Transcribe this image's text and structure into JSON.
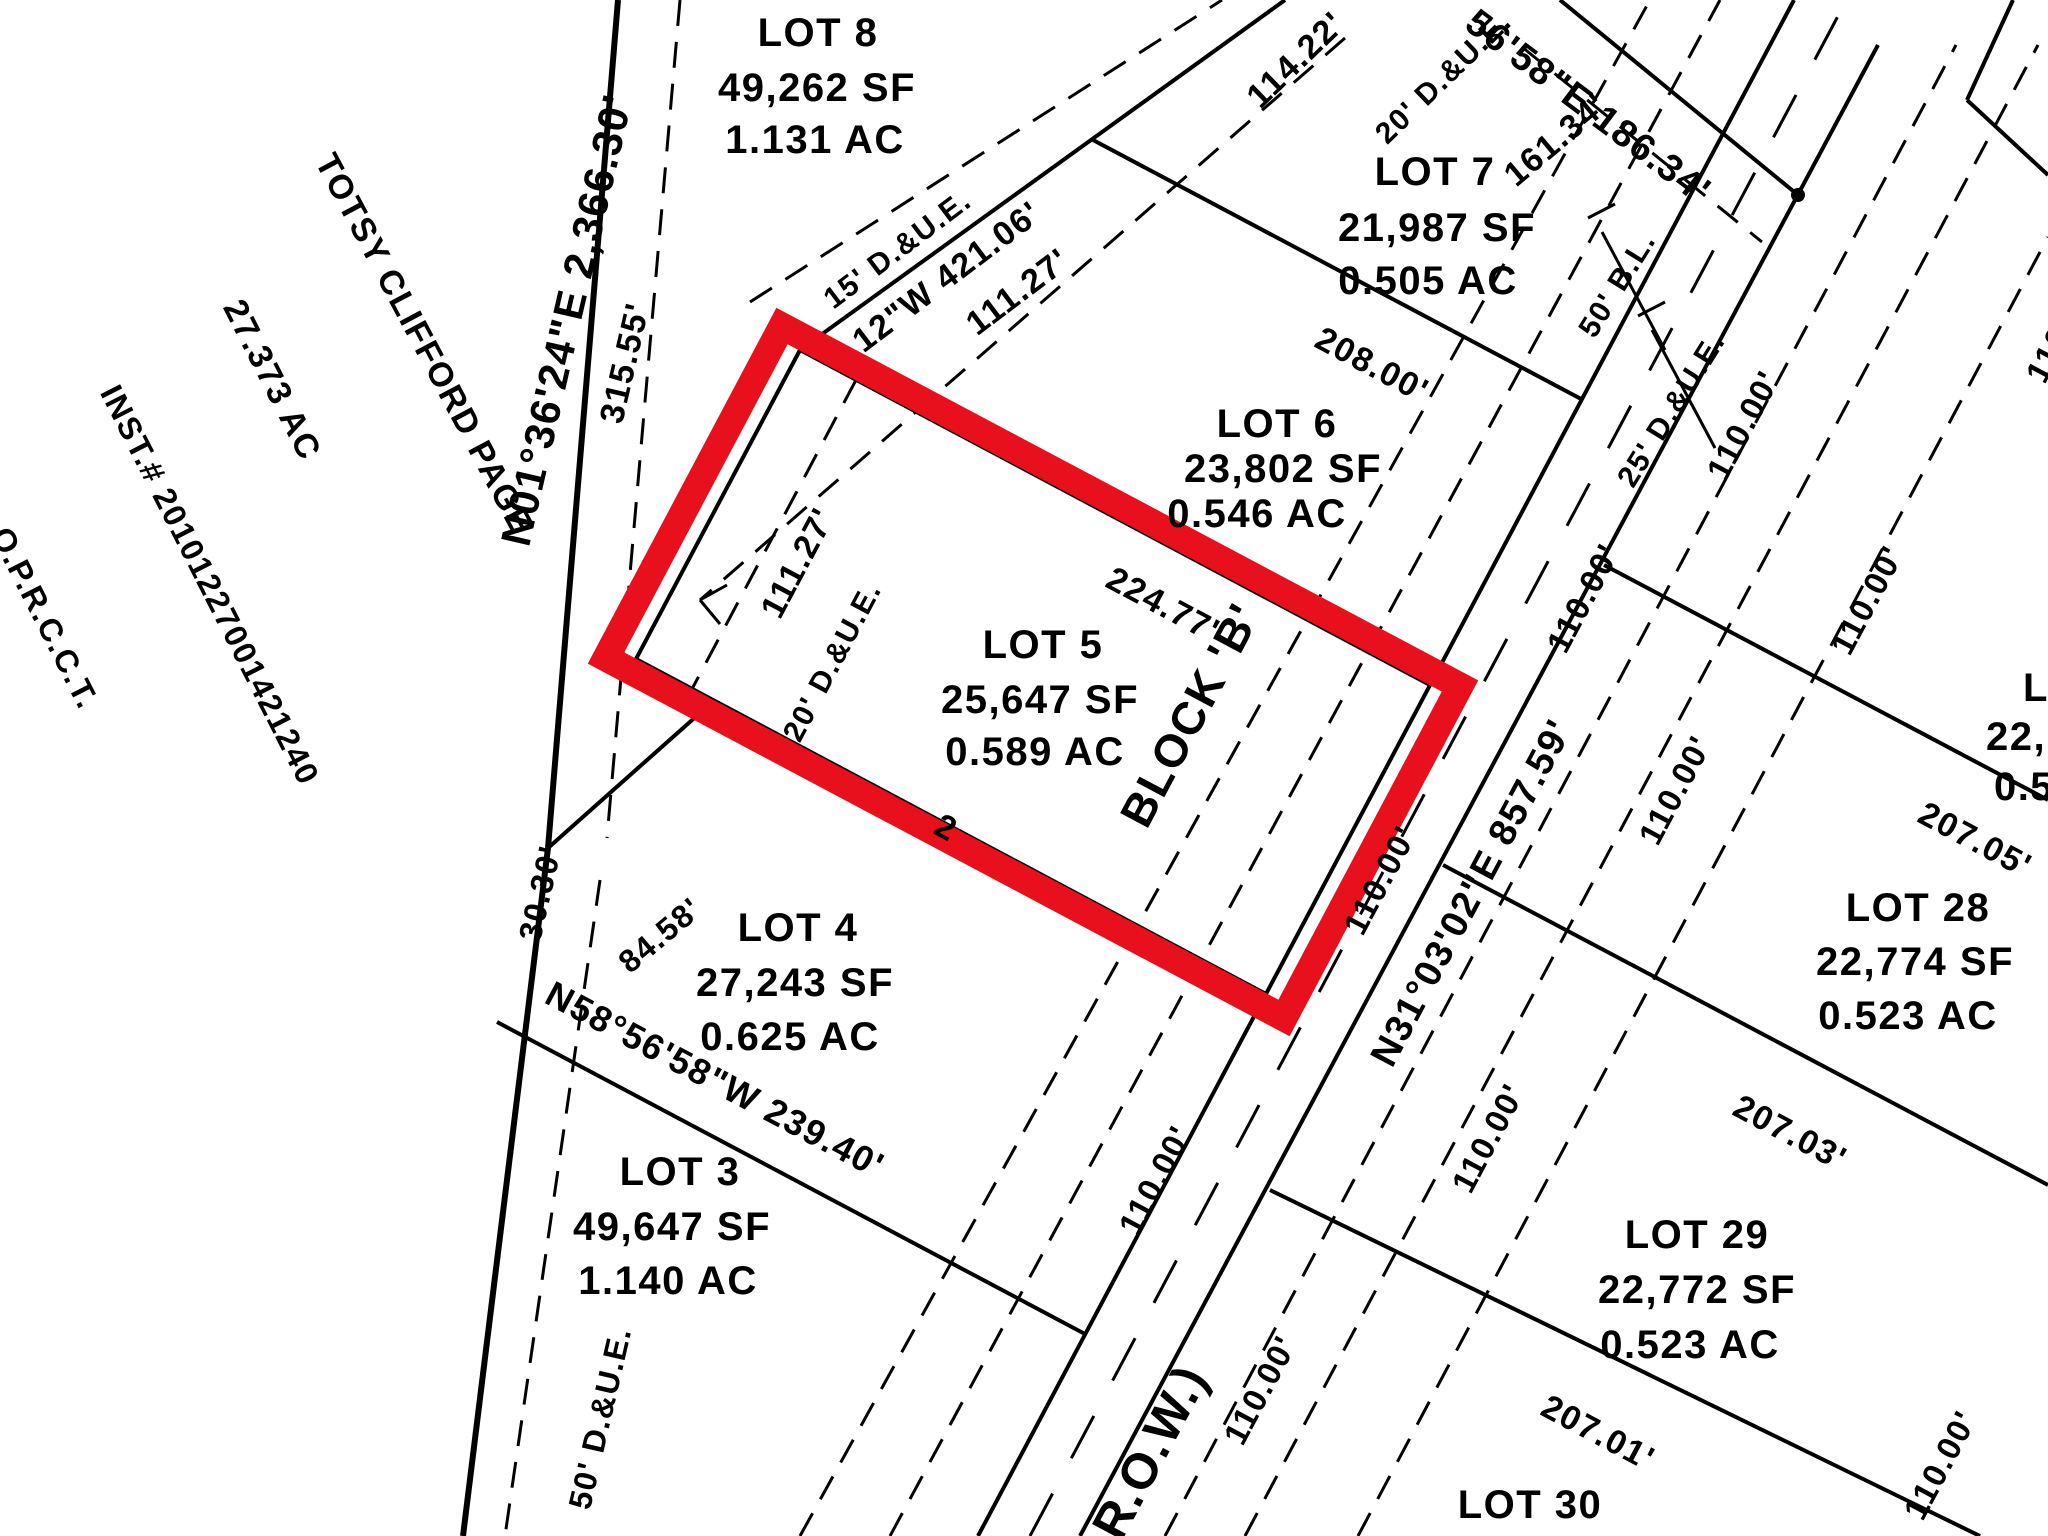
{
  "canvas": {
    "width": 2048,
    "height": 1536,
    "background": "#ffffff",
    "ink": "#000000"
  },
  "highlight": {
    "selected_parcel": "LOT 5",
    "color": "#e8101c",
    "border_px": 27
  },
  "adjacent_owner": {
    "name": "TOTSY CLIFFORD PAGE",
    "acreage": "27.373 AC",
    "instrument": "INST.# 20101227001421240",
    "records": "O.P.R.C.C.T."
  },
  "lots": [
    {
      "id": "LOT 8",
      "sf": "49,262 SF",
      "ac": "1.131 AC"
    },
    {
      "id": "LOT 7",
      "sf": "21,987 SF",
      "ac": "0.505 AC"
    },
    {
      "id": "LOT 6",
      "sf": "23,802 SF",
      "ac": "0.546 AC"
    },
    {
      "id": "LOT 5",
      "sf": "25,647 SF",
      "ac": "0.589 AC",
      "highlighted": true,
      "block": "BLOCK 'B'"
    },
    {
      "id": "LOT 4",
      "sf": "27,243 SF",
      "ac": "0.625 AC"
    },
    {
      "id": "LOT 3",
      "sf": "49,647 SF",
      "ac": "1.140 AC"
    },
    {
      "id": "LOT 28",
      "sf": "22,774 SF",
      "ac": "0.523 AC"
    },
    {
      "id": "LOT 29",
      "sf": "22,772 SF",
      "ac": "0.523 AC"
    },
    {
      "id": "LOT 30"
    }
  ],
  "bearings": [
    "N01°36'24\"E 2,366.30'",
    "12\"W 421.06'",
    "56'58\"E 186.34'",
    "N58°56'58\"W 239.40'",
    "N31°03'02\"E 857.59'"
  ],
  "labels": [
    {
      "name": "owner-name",
      "text": "TOTSY CLIFFORD PAGE",
      "x": 424,
      "y": 344,
      "rot": 62,
      "size": 34
    },
    {
      "name": "owner-acreage",
      "text": "27.373 AC",
      "x": 272,
      "y": 380,
      "rot": 63,
      "size": 34
    },
    {
      "name": "owner-instrument",
      "text": "INST.# 20101227001421240",
      "x": 210,
      "y": 585,
      "rot": 63,
      "size": 32
    },
    {
      "name": "owner-records",
      "text": "O.P.R.C.C.T.",
      "x": 45,
      "y": 618,
      "rot": 63,
      "size": 32
    },
    {
      "name": "bearing-west-boundary",
      "text": "N01°36'24\"E 2,366.30'",
      "x": 567,
      "y": 320,
      "rot": -77,
      "size": 42
    },
    {
      "name": "dim-315-55",
      "text": "315.55'",
      "x": 625,
      "y": 363,
      "rot": -77,
      "size": 34
    },
    {
      "name": "dim-30-30",
      "text": "30.30'",
      "x": 540,
      "y": 893,
      "rot": -77,
      "size": 32
    },
    {
      "name": "easement-50-due",
      "text": "50' D.&U.E.",
      "x": 600,
      "y": 1418,
      "rot": -77,
      "size": 32
    },
    {
      "name": "dim-84-58",
      "text": "84.58'",
      "x": 660,
      "y": 935,
      "rot": -40,
      "size": 32
    },
    {
      "name": "easement-15-due",
      "text": "15' D.&U.E.",
      "x": 898,
      "y": 250,
      "rot": -37,
      "size": 30
    },
    {
      "name": "bearing-rear-line",
      "text": "12\"W 421.06'",
      "x": 947,
      "y": 277,
      "rot": -37,
      "size": 34
    },
    {
      "name": "dim-111-27-outer",
      "text": "111.27'",
      "x": 1018,
      "y": 292,
      "rot": -37,
      "size": 34
    },
    {
      "name": "dim-114-22",
      "text": "114.22'",
      "x": 1296,
      "y": 60,
      "rot": -44,
      "size": 34
    },
    {
      "name": "easement-20-due-top",
      "text": "20' D.&U.E.",
      "x": 1444,
      "y": 78,
      "rot": -44,
      "size": 30
    },
    {
      "name": "dim-161-34",
      "text": "161.34'",
      "x": 1556,
      "y": 140,
      "rot": -40,
      "size": 34
    },
    {
      "name": "bearing-north-boundary",
      "text": "56'58\"E 186.34'",
      "x": 1588,
      "y": 107,
      "rot": 37,
      "size": 38
    },
    {
      "name": "lot8-title",
      "text": "LOT 8",
      "x": 818,
      "y": 33,
      "rot": 0,
      "size": 40
    },
    {
      "name": "lot8-sf",
      "text": "49,262 SF",
      "x": 817,
      "y": 88,
      "rot": 0,
      "size": 40
    },
    {
      "name": "lot8-ac",
      "text": "1.131 AC",
      "x": 815,
      "y": 140,
      "rot": 0,
      "size": 40
    },
    {
      "name": "lot7-title",
      "text": "LOT 7",
      "x": 1435,
      "y": 172,
      "rot": 0,
      "size": 40
    },
    {
      "name": "lot7-sf",
      "text": "21,987 SF",
      "x": 1437,
      "y": 228,
      "rot": 0,
      "size": 40
    },
    {
      "name": "lot7-ac",
      "text": "0.505 AC",
      "x": 1428,
      "y": 281,
      "rot": 0,
      "size": 40
    },
    {
      "name": "lot6-title",
      "text": "LOT 6",
      "x": 1277,
      "y": 424,
      "rot": 0,
      "size": 40
    },
    {
      "name": "lot6-sf",
      "text": "23,802 SF",
      "x": 1283,
      "y": 469,
      "rot": 0,
      "size": 40
    },
    {
      "name": "lot6-ac",
      "text": "0.546 AC",
      "x": 1257,
      "y": 514,
      "rot": 0,
      "size": 40
    },
    {
      "name": "lot5-title",
      "text": "LOT 5",
      "x": 1043,
      "y": 645,
      "rot": 0,
      "size": 40
    },
    {
      "name": "lot5-sf",
      "text": "25,647 SF",
      "x": 1040,
      "y": 700,
      "rot": 0,
      "size": 40
    },
    {
      "name": "lot5-ac",
      "text": "0.589 AC",
      "x": 1035,
      "y": 752,
      "rot": 0,
      "size": 40
    },
    {
      "name": "lot4-title",
      "text": "LOT 4",
      "x": 798,
      "y": 928,
      "rot": 0,
      "size": 40
    },
    {
      "name": "lot4-sf",
      "text": "27,243 SF",
      "x": 795,
      "y": 983,
      "rot": 0,
      "size": 40
    },
    {
      "name": "lot4-ac",
      "text": "0.625 AC",
      "x": 790,
      "y": 1037,
      "rot": 0,
      "size": 40
    },
    {
      "name": "lot3-title",
      "text": "LOT 3",
      "x": 680,
      "y": 1172,
      "rot": 0,
      "size": 40
    },
    {
      "name": "lot3-sf",
      "text": "49,647 SF",
      "x": 672,
      "y": 1227,
      "rot": 0,
      "size": 40
    },
    {
      "name": "lot3-ac",
      "text": "1.140 AC",
      "x": 668,
      "y": 1281,
      "rot": 0,
      "size": 40
    },
    {
      "name": "lot28-title",
      "text": "LOT 28",
      "x": 1918,
      "y": 908,
      "rot": 0,
      "size": 40
    },
    {
      "name": "lot28-sf",
      "text": "22,774 SF",
      "x": 1915,
      "y": 962,
      "rot": 0,
      "size": 40
    },
    {
      "name": "lot28-ac",
      "text": "0.523 AC",
      "x": 1908,
      "y": 1016,
      "rot": 0,
      "size": 40
    },
    {
      "name": "lot29-title",
      "text": "LOT 29",
      "x": 1697,
      "y": 1235,
      "rot": 0,
      "size": 40
    },
    {
      "name": "lot29-sf",
      "text": "22,772 SF",
      "x": 1697,
      "y": 1290,
      "rot": 0,
      "size": 40
    },
    {
      "name": "lot29-ac",
      "text": "0.523 AC",
      "x": 1690,
      "y": 1345,
      "rot": 0,
      "size": 40
    },
    {
      "name": "lot30-title",
      "text": "LOT 30",
      "x": 1530,
      "y": 1505,
      "rot": 0,
      "size": 40
    },
    {
      "name": "lot27-title-partial",
      "text": "L",
      "x": 2036,
      "y": 688,
      "rot": 0,
      "size": 40
    },
    {
      "name": "lot27-sf-partial",
      "text": "22,",
      "x": 2016,
      "y": 737,
      "rot": 0,
      "size": 40
    },
    {
      "name": "lot27-ac-partial",
      "text": "0.5",
      "x": 2024,
      "y": 787,
      "rot": 0,
      "size": 40
    },
    {
      "name": "dim-208-00",
      "text": "208.00'",
      "x": 1372,
      "y": 365,
      "rot": 28,
      "size": 34
    },
    {
      "name": "dim-224-77",
      "text": "224.77'",
      "x": 1163,
      "y": 605,
      "rot": 28,
      "size": 34
    },
    {
      "name": "bearing-lot3-lot4",
      "text": "N58°56'58\"W 239.40'",
      "x": 715,
      "y": 1080,
      "rot": 28,
      "size": 36
    },
    {
      "name": "dim-207-05",
      "text": "207.05'",
      "x": 1975,
      "y": 840,
      "rot": 28,
      "size": 34
    },
    {
      "name": "dim-207-03",
      "text": "207.03'",
      "x": 1790,
      "y": 1133,
      "rot": 28,
      "size": 34
    },
    {
      "name": "dim-207-01",
      "text": "207.01'",
      "x": 1598,
      "y": 1433,
      "rot": 28,
      "size": 34
    },
    {
      "name": "dim-lot4-fragment",
      "text": "2",
      "x": 946,
      "y": 828,
      "rot": 28,
      "size": 34
    },
    {
      "name": "dim-111-27-inner",
      "text": "111.27'",
      "x": 798,
      "y": 563,
      "rot": -62,
      "size": 34
    },
    {
      "name": "easement-20-due-lot5",
      "text": "20' D.&U.E.",
      "x": 833,
      "y": 662,
      "rot": -62,
      "size": 30
    },
    {
      "name": "block-b-label",
      "text": "BLOCK 'B'",
      "x": 1190,
      "y": 715,
      "rot": -62,
      "size": 46
    },
    {
      "name": "bearing-road",
      "text": "N31°03'02\"E 857.59'",
      "x": 1472,
      "y": 893,
      "rot": -62,
      "size": 38
    },
    {
      "name": "row-label",
      "text": "R.O.W.)",
      "x": 1150,
      "y": 1452,
      "rot": -62,
      "size": 50
    },
    {
      "name": "setback-50-bl",
      "text": "50' B.L.",
      "x": 1618,
      "y": 285,
      "rot": -58,
      "size": 30
    },
    {
      "name": "easement-25-due",
      "text": "25' D.&U.E.",
      "x": 1672,
      "y": 410,
      "rot": -58,
      "size": 30
    },
    {
      "name": "frontage-lot5",
      "text": "110.00'",
      "x": 1380,
      "y": 880,
      "rot": -62,
      "size": 33
    },
    {
      "name": "frontage-lot3",
      "text": "110.00'",
      "x": 1155,
      "y": 1180,
      "rot": -62,
      "size": 33
    },
    {
      "name": "frontage-east-1",
      "text": "110.00'",
      "x": 1583,
      "y": 598,
      "rot": -62,
      "size": 33
    },
    {
      "name": "frontage-east-2",
      "text": "110.00'",
      "x": 1867,
      "y": 600,
      "rot": -62,
      "size": 33
    },
    {
      "name": "frontage-lot7",
      "text": "110.00'",
      "x": 1743,
      "y": 425,
      "rot": -62,
      "size": 33
    },
    {
      "name": "frontage-lot28",
      "text": "110.00'",
      "x": 1675,
      "y": 790,
      "rot": -62,
      "size": 33
    },
    {
      "name": "frontage-lot29",
      "text": "110.00'",
      "x": 1488,
      "y": 1138,
      "rot": -62,
      "size": 33
    },
    {
      "name": "frontage-lot29-east",
      "text": "110.00'",
      "x": 1940,
      "y": 1465,
      "rot": -62,
      "size": 33
    },
    {
      "name": "frontage-lot30",
      "text": "110.00'",
      "x": 1260,
      "y": 1390,
      "rot": -62,
      "size": 33
    },
    {
      "name": "frontage-edge-partial",
      "text": "110.00'",
      "x": 2062,
      "y": 328,
      "rot": -62,
      "size": 33
    }
  ],
  "lines": [
    {
      "name": "west-boundary-upper",
      "x1": 618,
      "y1": 0,
      "x2": 548,
      "y2": 848,
      "w": 6
    },
    {
      "name": "west-boundary-lower",
      "x1": 548,
      "y1": 848,
      "x2": 463,
      "y2": 1536,
      "w": 6
    },
    {
      "name": "jog-84-58",
      "x1": 548,
      "y1": 848,
      "x2": 700,
      "y2": 713,
      "w": 4
    },
    {
      "name": "jog-corner",
      "x1": 700,
      "y1": 713,
      "x2": 636,
      "y2": 659,
      "w": 4
    },
    {
      "name": "rear-line-421",
      "x1": 800,
      "y1": 350,
      "x2": 1285,
      "y2": 0,
      "w": 4
    },
    {
      "name": "lot5-nw-side",
      "x1": 800,
      "y1": 350,
      "x2": 636,
      "y2": 659,
      "w": 4
    },
    {
      "name": "divider-lot5-lot6",
      "x1": 800,
      "y1": 350,
      "x2": 1430,
      "y2": 685,
      "w": 4
    },
    {
      "name": "divider-lot4-lot5",
      "x1": 636,
      "y1": 659,
      "x2": 1266,
      "y2": 994,
      "w": 4
    },
    {
      "name": "road-west-edge",
      "x1": 978,
      "y1": 1536,
      "x2": 1794,
      "y2": 0,
      "w": 4
    },
    {
      "name": "road-east-edge",
      "x1": 1080,
      "y1": 1536,
      "x2": 1878,
      "y2": 45,
      "w": 4
    },
    {
      "name": "divider-lot3-lot4",
      "x1": 497,
      "y1": 1022,
      "x2": 1085,
      "y2": 1334,
      "w": 4
    },
    {
      "name": "divider-lot6-lot7",
      "x1": 1093,
      "y1": 140,
      "x2": 1583,
      "y2": 400,
      "w": 4
    },
    {
      "name": "north-boundary",
      "x1": 1560,
      "y1": 0,
      "x2": 1798,
      "y2": 195,
      "w": 4
    },
    {
      "name": "north-due-line",
      "x1": 1522,
      "y1": 47,
      "x2": 1762,
      "y2": 242,
      "w": 3,
      "dash": "26 16"
    },
    {
      "name": "ne-corner-a",
      "x1": 2013,
      "y1": 0,
      "x2": 1967,
      "y2": 100,
      "w": 4
    },
    {
      "name": "ne-corner-b",
      "x1": 1967,
      "y1": 100,
      "x2": 2048,
      "y2": 175,
      "w": 4
    },
    {
      "name": "divider-lot27-lot28",
      "x1": 1604,
      "y1": 565,
      "x2": 2048,
      "y2": 800,
      "w": 4
    },
    {
      "name": "divider-lot28-lot29",
      "x1": 1443,
      "y1": 865,
      "x2": 2048,
      "y2": 1185,
      "w": 4
    },
    {
      "name": "divider-lot29-lot30",
      "x1": 1270,
      "y1": 1190,
      "x2": 1980,
      "y2": 1536,
      "w": 4
    },
    {
      "name": "dashed-west-upper",
      "x1": 680,
      "y1": 0,
      "x2": 607,
      "y2": 838,
      "w": 3,
      "dash": "26 16"
    },
    {
      "name": "dashed-west-lower",
      "x1": 600,
      "y1": 880,
      "x2": 505,
      "y2": 1536,
      "w": 3,
      "dash": "26 16"
    },
    {
      "name": "dashed-rear-nw",
      "x1": 750,
      "y1": 302,
      "x2": 1222,
      "y2": 0,
      "w": 3,
      "dash": "26 16"
    },
    {
      "name": "dashed-rear-se",
      "x1": 1345,
      "y1": 38,
      "x2": 700,
      "y2": 600,
      "w": 3,
      "dash": "26 16"
    },
    {
      "name": "arrowhead-a",
      "x1": 700,
      "y1": 600,
      "x2": 727,
      "y2": 585,
      "w": 3
    },
    {
      "name": "arrowhead-b",
      "x1": 700,
      "y1": 600,
      "x2": 720,
      "y2": 624,
      "w": 3
    },
    {
      "name": "dashed-lot5-due",
      "x1": 856,
      "y1": 380,
      "x2": 692,
      "y2": 689,
      "w": 3,
      "dash": "26 16"
    },
    {
      "name": "dashed-bl-west-a",
      "x1": 890,
      "y1": 1536,
      "x2": 1720,
      "y2": 0,
      "w": 3,
      "dash": "26 16"
    },
    {
      "name": "dashed-bl-west-b",
      "x1": 800,
      "y1": 1536,
      "x2": 1650,
      "y2": 0,
      "w": 3,
      "dash": "26 16"
    },
    {
      "name": "road-centerline",
      "x1": 1030,
      "y1": 1536,
      "x2": 1838,
      "y2": 16,
      "w": 3,
      "dash": "48 40"
    },
    {
      "name": "dashed-bl-east-a",
      "x1": 1165,
      "y1": 1536,
      "x2": 1956,
      "y2": 45,
      "w": 3,
      "dash": "26 16"
    },
    {
      "name": "dashed-bl-east-b",
      "x1": 1245,
      "y1": 1536,
      "x2": 2038,
      "y2": 45,
      "w": 3,
      "dash": "26 16"
    },
    {
      "name": "dashed-bl-east-c",
      "x1": 1358,
      "y1": 1536,
      "x2": 2048,
      "y2": 237,
      "w": 3,
      "dash": "26 16"
    },
    {
      "name": "bracket-50bl-hook",
      "x1": 1588,
      "y1": 218,
      "x2": 1615,
      "y2": 204,
      "w": 3
    },
    {
      "name": "bracket-50bl",
      "x1": 1602,
      "y1": 232,
      "x2": 1665,
      "y2": 350,
      "w": 3
    },
    {
      "name": "bracket-25due-hook",
      "x1": 1638,
      "y1": 316,
      "x2": 1665,
      "y2": 302,
      "w": 3
    },
    {
      "name": "bracket-25due",
      "x1": 1652,
      "y1": 330,
      "x2": 1715,
      "y2": 448,
      "w": 3
    }
  ],
  "polygons": [
    {
      "name": "lot5-highlight-outline",
      "points": "782,326 1460,686 1284,1018 606,658",
      "stroke": "#e8101c",
      "w": 27
    }
  ],
  "dots": [
    {
      "name": "corner-monument-dot",
      "x": 1798,
      "y": 195,
      "r": 7
    }
  ]
}
